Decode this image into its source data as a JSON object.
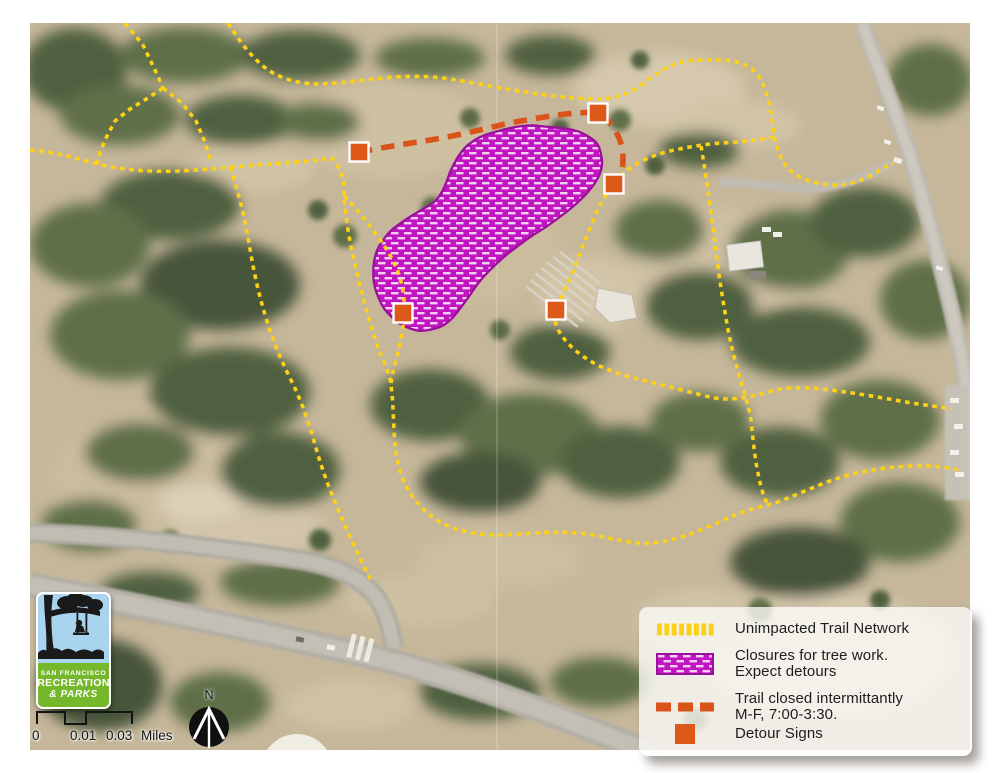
{
  "map": {
    "kind": "aerial-photo-with-trail-overlays",
    "detour_sign_count": 5
  },
  "legend": {
    "items": [
      {
        "line1": "Unimpacted Trail Network",
        "line2": "",
        "swatch": "yellow-dashed-line"
      },
      {
        "line1": "Closures for tree work.",
        "line2": "Expect detours",
        "swatch": "magenta-hatched-area"
      },
      {
        "line1": "Trail closed intermittantly",
        "line2": "M-F, 7:00-3:30.",
        "swatch": "red-dashed-line"
      },
      {
        "line1": "Detour Signs",
        "line2": "",
        "swatch": "orange-square"
      }
    ],
    "colors": {
      "trail_yellow": "#FCD116",
      "closure_magenta": "#C215C2",
      "closure_outline": "#99119B",
      "closed_trail_red": "#D9531B",
      "detour_orange": "#DE5819"
    }
  },
  "logo": {
    "line1": "SAN FRANCISCO",
    "line2": "RECREATION",
    "line3": "& PARKS"
  },
  "scale_bar": {
    "label_start": "0",
    "label_mid": "0.01",
    "label_end": "0.03",
    "unit": "Miles"
  },
  "compass": {
    "label": "N"
  }
}
